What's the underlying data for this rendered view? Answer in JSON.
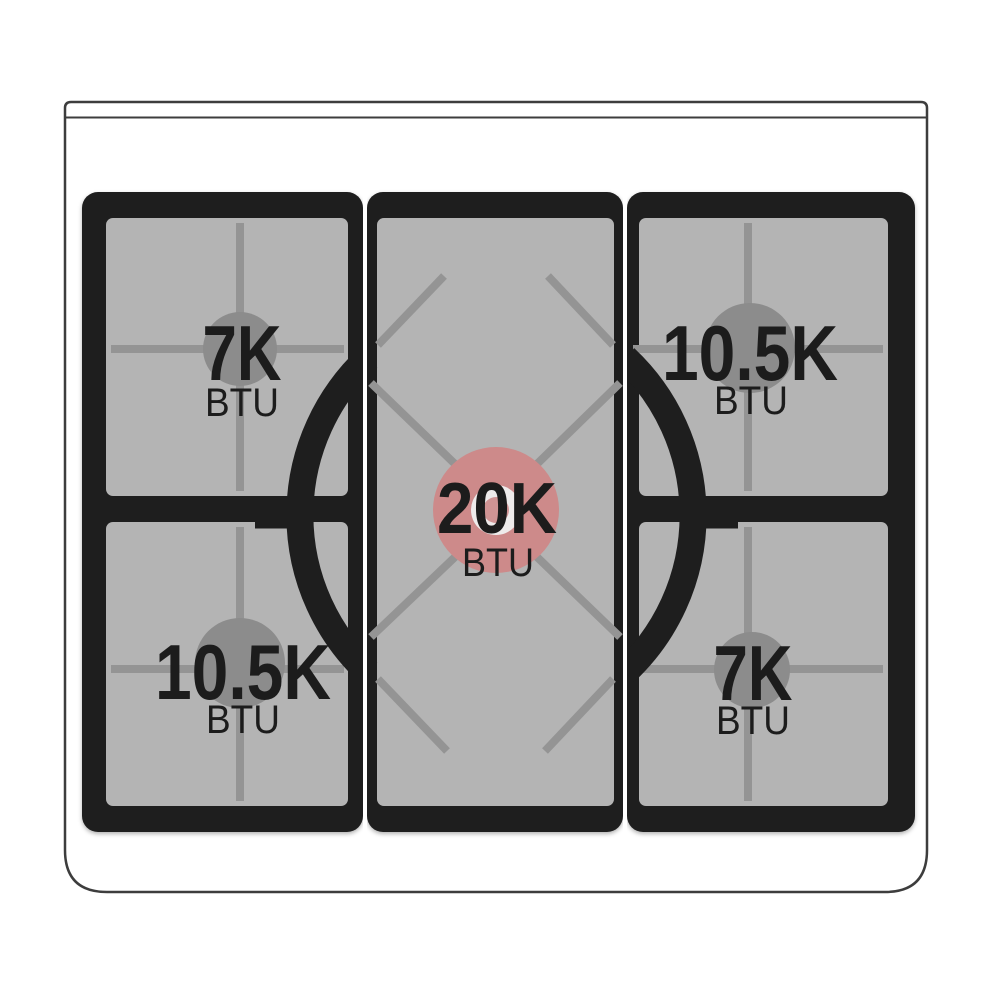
{
  "diagram": {
    "burners": {
      "top_left": {
        "power": "7K",
        "unit": "BTU"
      },
      "top_right": {
        "power": "10.5K",
        "unit": "BTU"
      },
      "center": {
        "power": "20K",
        "unit": "BTU"
      },
      "bottom_left": {
        "power": "10.5K",
        "unit": "BTU"
      },
      "bottom_right": {
        "power": "7K",
        "unit": "BTU"
      }
    },
    "colors": {
      "highlighted_burner_cap": "#cd8a8a",
      "standard_burner_cap": "#8c8c8c",
      "grate": "#1e1e1e",
      "cooktop_surface": "#b4b4b4",
      "grate_line": "#949494",
      "label_text": "#1c1c1c",
      "body_outline": "#3d3d3d"
    }
  }
}
